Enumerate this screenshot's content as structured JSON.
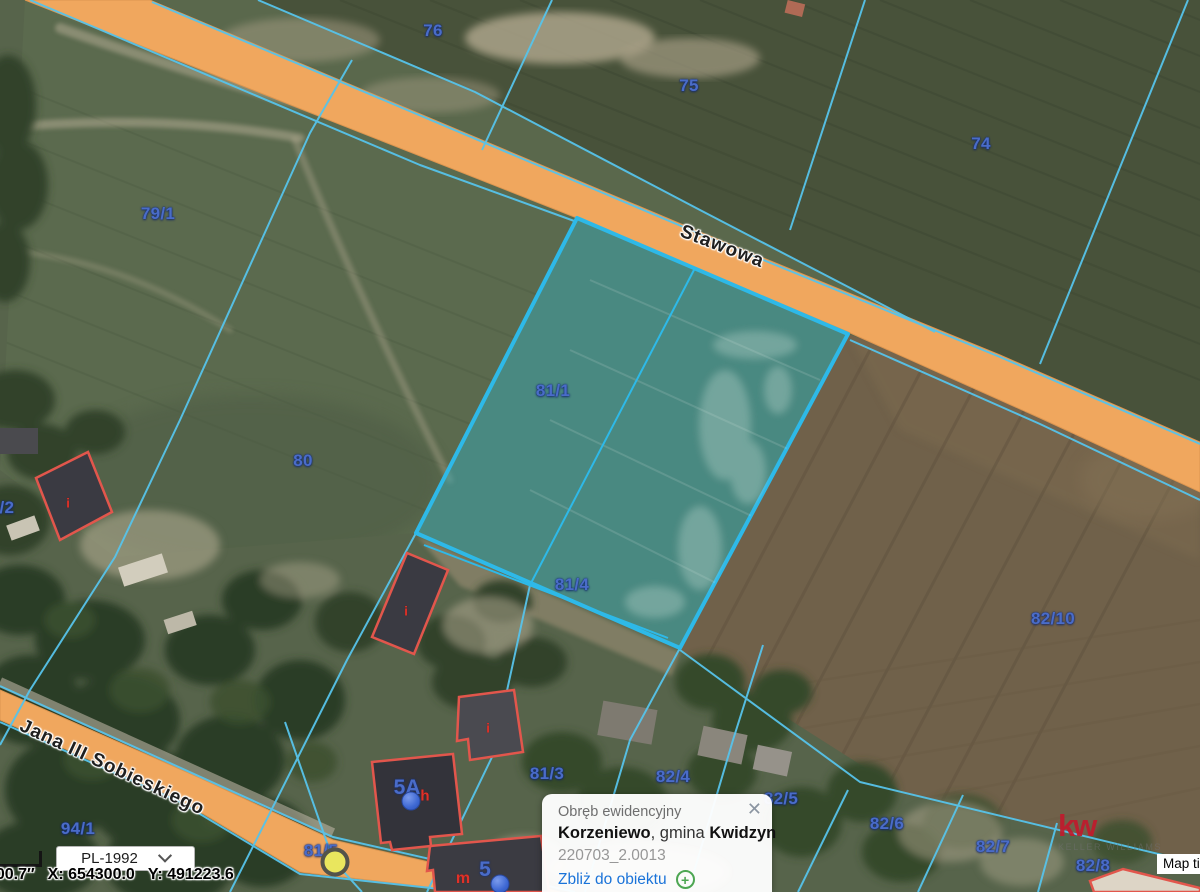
{
  "map": {
    "streets": [
      {
        "name": "Stawowa"
      },
      {
        "name": "Jana III Sobieskiego"
      }
    ],
    "parcels": [
      {
        "label": "76",
        "x": 433,
        "y": 31
      },
      {
        "label": "75",
        "x": 689,
        "y": 86
      },
      {
        "label": "74",
        "x": 981,
        "y": 144
      },
      {
        "label": "79/1",
        "x": 158,
        "y": 214
      },
      {
        "label": "80",
        "x": 303,
        "y": 461
      },
      {
        "label": "81/1",
        "x": 553,
        "y": 391
      },
      {
        "label": "81/4",
        "x": 572,
        "y": 585
      },
      {
        "label": "82/10",
        "x": 1053,
        "y": 619
      },
      {
        "label": "9/2",
        "x": 2,
        "y": 508
      },
      {
        "label": "94/1",
        "x": 78,
        "y": 829
      },
      {
        "label": "81/5",
        "x": 321,
        "y": 851
      },
      {
        "label": "81/3",
        "x": 547,
        "y": 774
      },
      {
        "label": "82/4",
        "x": 673,
        "y": 777
      },
      {
        "label": "82/5",
        "x": 781,
        "y": 799
      },
      {
        "label": "82/6",
        "x": 887,
        "y": 824
      },
      {
        "label": "82/7",
        "x": 993,
        "y": 847
      },
      {
        "label": "82/8",
        "x": 1093,
        "y": 866
      }
    ],
    "building_labels": [
      {
        "text": "i",
        "color": "red",
        "x": 68,
        "y": 503,
        "size": 13
      },
      {
        "text": "i",
        "color": "red",
        "x": 406,
        "y": 611,
        "size": 13
      },
      {
        "text": "i",
        "color": "red",
        "x": 488,
        "y": 728,
        "size": 13
      },
      {
        "text": "5A",
        "color": "blue",
        "x": 407,
        "y": 788,
        "size": 21
      },
      {
        "text": "h",
        "color": "red",
        "x": 425,
        "y": 796,
        "size": 15
      },
      {
        "text": "m",
        "color": "red",
        "x": 463,
        "y": 879,
        "size": 16
      },
      {
        "text": "5",
        "color": "blue",
        "x": 485,
        "y": 870,
        "size": 21
      }
    ],
    "markers": [
      {
        "type": "vertex",
        "x": 335,
        "y": 862,
        "color": "#e9e65e"
      },
      {
        "type": "address",
        "x": 411,
        "y": 801,
        "color": "#3e68d3"
      },
      {
        "type": "address",
        "x": 500,
        "y": 884,
        "color": "#3e68d3"
      }
    ]
  },
  "popup": {
    "title": "Obręb ewidencyjny",
    "name_primary": "Korzeniewo",
    "name_separator": ", gmina ",
    "name_secondary": "Kwidzyn",
    "code": "220703_2.0013",
    "zoom_link": "Zbliż do obiektu"
  },
  "status_bar": {
    "crs": "PL-1992",
    "coord_fragment": "′00.7″",
    "coord_x": "X: 654300.0",
    "coord_y": "Y: 491223.6"
  },
  "watermark": {
    "logo": "kw",
    "subtitle": "KELLER WILLIAMS"
  },
  "attribution": {
    "label": "Map tiles"
  },
  "icons": {
    "close": "✕",
    "plus": "+"
  },
  "colors": {
    "parcel_line": "#57c3ea",
    "highlight_border": "#2eb9e8",
    "highlight_fill": "rgba(62,170,178,0.52)",
    "road": "#f0a75e",
    "parcel_label": "#4a6cc8",
    "building_outline": "#e2564c",
    "link_blue": "#1a73d9",
    "kw_red": "#c01b2d",
    "vertex_yellow": "#e9e65e"
  }
}
